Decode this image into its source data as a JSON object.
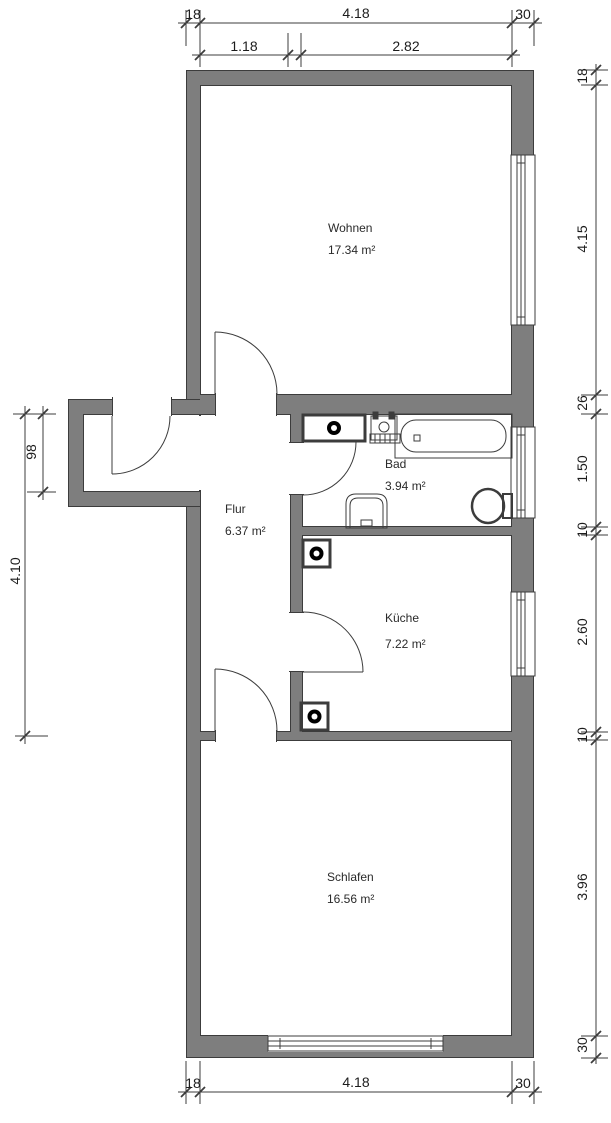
{
  "title": "Apartment floor plan",
  "rooms": {
    "wohnen": {
      "name": "Wohnen",
      "area": "17.34 m²"
    },
    "flur": {
      "name": "Flur",
      "area": "6.37 m²"
    },
    "bad": {
      "name": "Bad",
      "area": "3.94 m²"
    },
    "kueche": {
      "name": "Küche",
      "area": "7.22 m²"
    },
    "schlafen": {
      "name": "Schlafen",
      "area": "16.56 m²"
    }
  },
  "dims": {
    "top1": [
      "18",
      "4.18",
      "30"
    ],
    "top2": [
      "1.18",
      "2.82"
    ],
    "right": [
      "18",
      "4.15",
      "26",
      "1.50",
      "10",
      "2.60",
      "10",
      "3.96",
      "30"
    ],
    "left": [
      "98",
      "4.10"
    ],
    "bottom": [
      "18",
      "4.18",
      "30"
    ]
  },
  "fixtures": [
    "bathtub",
    "water-heater",
    "washbasin",
    "wc",
    "stove-connection-bad",
    "stove-connection-kueche-top",
    "stove-connection-kueche-bottom"
  ],
  "colors": {
    "wall_fill": "#7e7e7e",
    "line": "#3c3c3c",
    "background": "#ffffff"
  }
}
